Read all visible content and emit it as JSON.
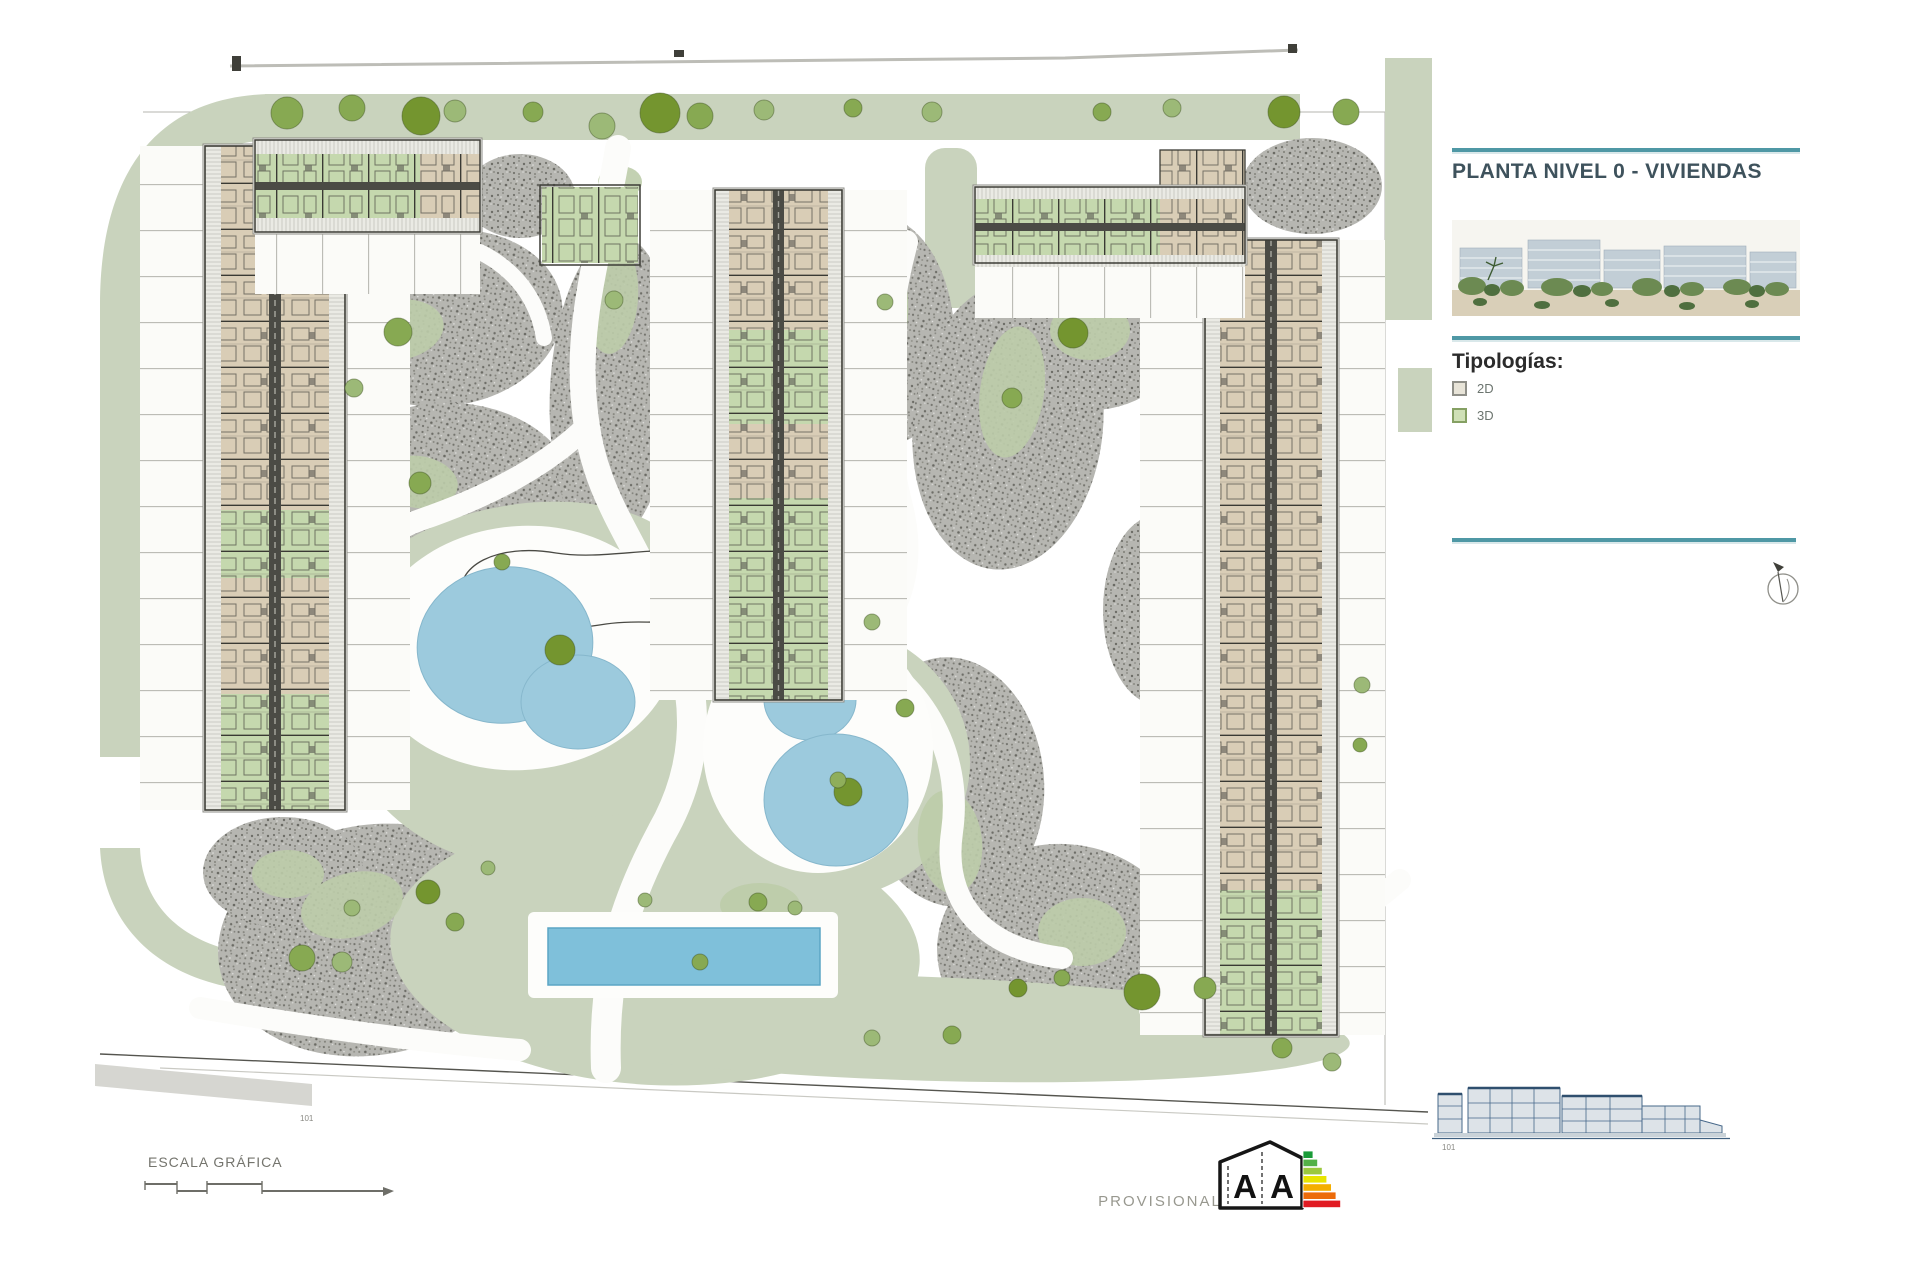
{
  "panel": {
    "title": "PLANTA NIVEL 0 - VIVIENDAS",
    "typologies_heading": "Tipologías:",
    "legend": [
      {
        "label": "2D",
        "swatch": "#e8e4d8"
      },
      {
        "label": "3D",
        "swatch": "#cfe0b6"
      }
    ],
    "rule_color": "#4f98a5"
  },
  "plan": {
    "scale_label": "ESCALA GRÁFICA",
    "site_ref_label": "101",
    "provisional_label": "PROVISIONAL",
    "elevation_ref_label": "101",
    "energy_rating": {
      "letter_left": "A",
      "letter_right": "A",
      "bar_colors": [
        "#199b38",
        "#53b147",
        "#9bc83e",
        "#e8e400",
        "#f4ae00",
        "#ec6b0a",
        "#e11b22"
      ]
    },
    "colors": {
      "lawn": "#c9d3bd",
      "gravel": "#b6b6b1",
      "pond": "#9ccadd",
      "pool": "#7fc0da",
      "unit_2d": "#d9cdb6",
      "unit_3d": "#c5d8ae"
    }
  }
}
